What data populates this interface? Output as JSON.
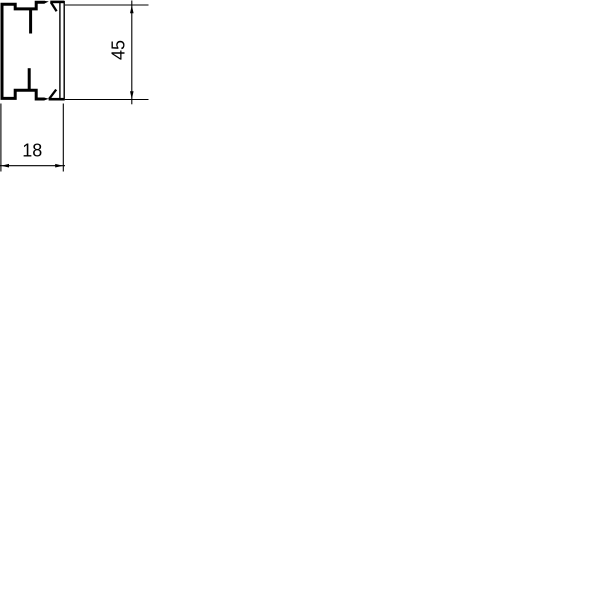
{
  "drawing": {
    "stroke_color": "#000000",
    "labels": {
      "height": "45",
      "width": "18"
    },
    "profile_shapes": [
      {
        "name": "base-outline",
        "kind": "path",
        "d": "M 44.5,2.2 L 36.2,2.2 L 36.2,8.9 L 15.2,8.9 L 15.2,4.2 L 2,4.2 L 2,98.4 L 15.2,98.4 L 15.2,90.3 L 36.2,90.3 L 36.2,99 L 44.5,99",
        "stroke": 3
      },
      {
        "name": "base-top-lip-wedge",
        "kind": "polygon",
        "points": "44,0.7 48.8,1.5 44,3.7",
        "fill": true
      },
      {
        "name": "base-bottom-lip-wedge",
        "kind": "polygon",
        "points": "44,97.5 48.8,98.7 44,100.5",
        "fill": true
      },
      {
        "name": "base-top-fin",
        "kind": "path",
        "d": "M 30.6,8 L 30.6,33.5",
        "stroke": 3
      },
      {
        "name": "base-bottom-fin",
        "kind": "path",
        "d": "M 29.2,91 L 29.2,68.2",
        "stroke": 3
      },
      {
        "name": "cover-outer-face",
        "kind": "path",
        "d": "M 64.2,0.8 L 64.2,100.4",
        "stroke": 1.4
      },
      {
        "name": "cover-inner-face",
        "kind": "path",
        "d": "M 59.9,1 L 59.9,100.2",
        "stroke": 1.4
      },
      {
        "name": "cover-top-hook",
        "kind": "path",
        "d": "M 64,1.9 L 50.3,1.9",
        "stroke": 2.6
      },
      {
        "name": "cover-top-barb",
        "kind": "path",
        "d": "M 50.9,2.3 L 56.6,11.2",
        "stroke": 2.3
      },
      {
        "name": "cover-bottom-hook",
        "kind": "path",
        "d": "M 64,99.2 L 48.6,99.2",
        "stroke": 2.6
      },
      {
        "name": "cover-bottom-barb",
        "kind": "path",
        "d": "M 49.2,98.8 L 56.2,89.6",
        "stroke": 2.3
      }
    ],
    "dimension_shapes": [
      {
        "name": "height-ext-line-top",
        "kind": "path",
        "d": "M 65,5 L 148.5,5",
        "stroke": 1.1
      },
      {
        "name": "height-ext-line-bottom",
        "kind": "path",
        "d": "M 64.8,99.5 L 148.5,99.5",
        "stroke": 1.1
      },
      {
        "name": "height-dim-line",
        "kind": "path",
        "d": "M 131.8,0.5 L 131.8,104.3",
        "stroke": 1.1
      },
      {
        "name": "height-arrow-top",
        "kind": "polygon",
        "points": "131.8,5.2 130,13.2 133.6,13.2",
        "fill": true
      },
      {
        "name": "height-arrow-bottom",
        "kind": "polygon",
        "points": "131.8,99.3 130,91.3 133.6,91.3",
        "fill": true
      },
      {
        "name": "width-ext-line-left",
        "kind": "path",
        "d": "M 0.9,103.5 L 0.9,171.5",
        "stroke": 1.1
      },
      {
        "name": "width-ext-line-right",
        "kind": "path",
        "d": "M 63.3,103.5 L 63.3,171.5",
        "stroke": 1.1
      },
      {
        "name": "width-dim-line",
        "kind": "path",
        "d": "M 0,165.7 L 65,165.7",
        "stroke": 1.1
      },
      {
        "name": "width-arrow-left",
        "kind": "polygon",
        "points": "1,165.7 9,163.9 9,167.5",
        "fill": true
      },
      {
        "name": "width-arrow-right",
        "kind": "polygon",
        "points": "63.2,165.7 55.2,163.9 55.2,167.5",
        "fill": true
      }
    ]
  }
}
